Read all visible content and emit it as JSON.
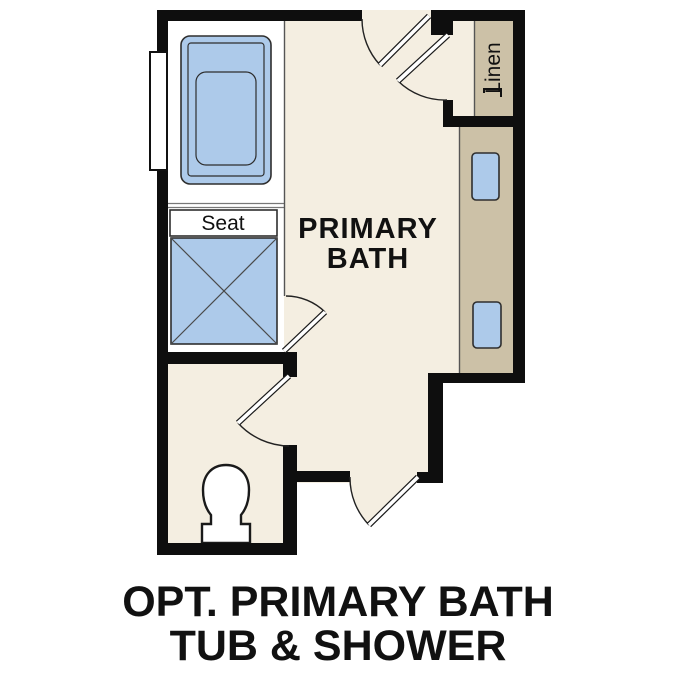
{
  "labels": {
    "room_line1": "PRIMARY",
    "room_line2": "BATH",
    "seat": "Seat",
    "linen": "Linen"
  },
  "caption": {
    "line1": "OPT. PRIMARY BATH",
    "line2": "TUB & SHOWER"
  },
  "colors": {
    "floor": "#f4eee1",
    "cabinet": "#ccc1a7",
    "fixture_blue": "#adcaea",
    "wall": "#0e0e0e",
    "text": "#111111"
  }
}
